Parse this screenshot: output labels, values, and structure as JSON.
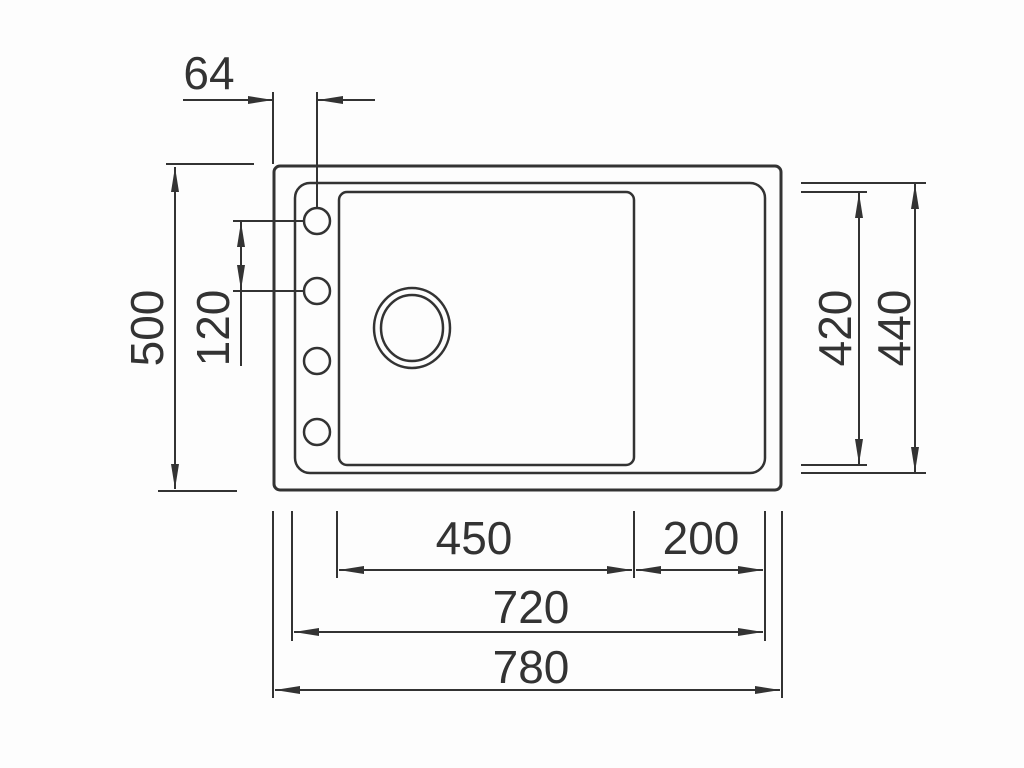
{
  "page": {
    "background_color": "#fdfdfd",
    "line_color": "#333333"
  },
  "drawing": {
    "kind": "technical-dimension-drawing",
    "subject": "sink-top-view",
    "dimensions": {
      "tap_hole_offset": "64",
      "overall_depth": "500",
      "tap_hole_spacing": "120",
      "bowl_depth": "420",
      "inner_depth": "440",
      "bowl_width": "450",
      "drainer_width": "200",
      "inner_width": "720",
      "overall_width": "780"
    }
  }
}
